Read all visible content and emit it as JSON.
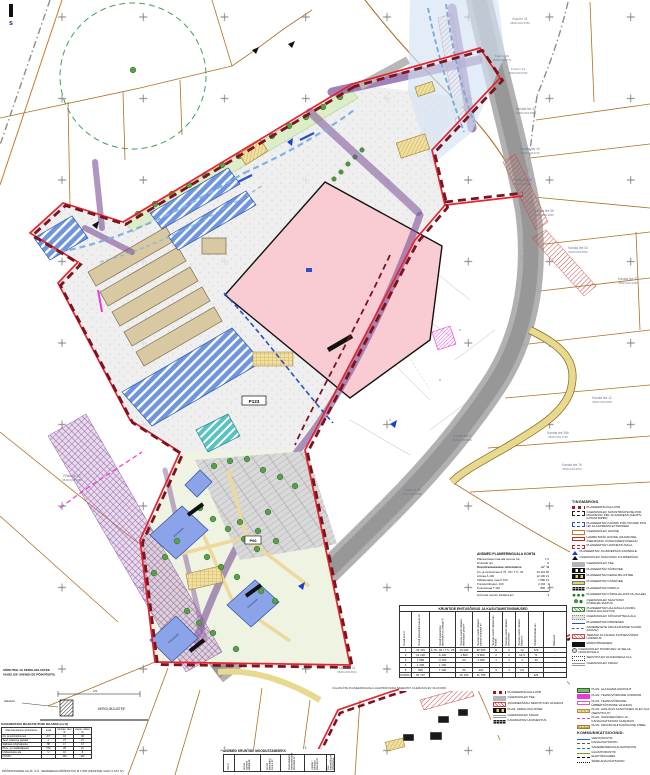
{
  "colors": {
    "plan_boundary_red": "#e4252f",
    "plan_boundary_maroon": "#7a1420",
    "parcel_orange": "#b06f25",
    "building_pink": "#f8ccd2",
    "water_blue": "#6f95dd",
    "utility_purple": "#7a4e96",
    "road_gray": "#a8a8a8",
    "magenta": "#e83ad8",
    "green_tree": "#5a9e4a",
    "path_yellow": "#edd99b"
  },
  "corner_mark": "s",
  "labels": {
    "p123": "P123",
    "p66": "P66",
    "floors": "3+5 korrust"
  },
  "captions": {
    "section1": "SÕIDUTEE JA KERGLIIKLUSTEE",
    "section2": "VAHELISE ÜHENDUSE PÕIKPROFIIL",
    "kergliiklustee": "KERGLIIKLUSTEE",
    "aarekivi": "Äärekivi",
    "dim": "4,5",
    "fragment": "VÄLJAVÕTE PLANEERINGUALA LÄHIPIIRKONNA SKEEMIST. OLEMASOLEV OLUKORD",
    "footer": "MÕÕDISTAMISE ALUS: O.Ü. GEODEESIA MÕÕDISTUS M 1:500 (KESKTEE VALD 3 KAT IV)"
  },
  "parcels": [
    {
      "name": "Kuuli tn 41",
      "code": "35201:001:0790"
    },
    {
      "name": "Kuuli tn 46",
      "code": "35201:001:0771"
    },
    {
      "name": "Kuuli tn 44",
      "code": "35201:001:0780"
    },
    {
      "name": "Kanala tee 42",
      "code": "35201:004:0695"
    },
    {
      "name": "Kanala tee 40",
      "code": "35201:004:0710"
    },
    {
      "name": "Kanala tee 38",
      "code": "35201:004:1550"
    },
    {
      "name": "Kanala tee 36",
      "code": "35201:004:0025"
    },
    {
      "name": "Kanala tee 34",
      "code": "35201:004:0640"
    },
    {
      "name": "Kanala tee 32",
      "code": "35201:004:1350"
    },
    {
      "name": "Kanala tee 12",
      "code": "35201:004:0065"
    },
    {
      "name": "Kanala tee 26b",
      "code": "35201:004:1760"
    },
    {
      "name": "Kanala tee 7b",
      "code": "35201:004:0013"
    },
    {
      "name": "Kanala tee 3",
      "code": "35201:004:0054"
    },
    {
      "name": "Laane tn 24",
      "code": "35201:004:0950"
    },
    {
      "name": "Laane tn 11",
      "code": "35201:004:0001"
    },
    {
      "name": "Piilaku tn 22",
      "code": "35201:004:1280"
    }
  ],
  "summary": {
    "title": "ANDMED PLANEERINGUALA KOHTA",
    "rows": [
      {
        "l": "Planeeritava maa-ala suurus ha",
        "v": "7,2"
      },
      {
        "l": "Kruntide arv",
        "v": "5"
      }
    ],
    "sub": "Krundi kasutamise sihtotstarve",
    "col1": "m²",
    "col2": "%",
    "uses": [
      [
        "Äri- ja tootmismaa Ä 75...95 / T 5...25",
        "34 115",
        "60"
      ],
      [
        "Ärimaa Ä 100",
        "12 130",
        "21"
      ],
      [
        "Üldkasutatav maa Ü 100",
        "7 580",
        "13"
      ],
      [
        "Transpordimaa L 100",
        "2 404",
        "4"
      ],
      [
        "Tootmismaa T 100",
        "895",
        "2"
      ]
    ],
    "note_l": "Korruste suurim lubatud arv",
    "note_v": "3"
  },
  "tables": {
    "main": {
      "title": "KRUNTIDE EHITUSÕIGUS JA KASUTAMISTINGIMUSED",
      "headers": [
        "Krundi pos nr",
        "Krundi planeeritud suurus m²",
        "Krundi kasutamise sihtotstarve ja osakaal %",
        "Hoonete suurim lubatud ehitisealune pind m²",
        "Hoonete suurim lubatud suletud brutopind m²",
        "Hoonete suurim lubatud arv krundil",
        "Hoonete suurim lubatud korruselisus",
        "Hoonete suurim lubatud kõrgus m",
        "Parkimiskohtade arv",
        "Märkused"
      ],
      "rows": [
        [
          "1",
          "34 115",
          "Ä 75...95 / T 5...25",
          "13 000",
          "30 600",
          "6",
          "2",
          "12",
          "123",
          "-"
        ],
        [
          "2",
          "12 130",
          "Ä 100",
          "1 800",
          "9 900",
          "2",
          "2",
          "14,5",
          "71",
          "-"
        ],
        [
          "3",
          "7 580",
          "Ü 100",
          "60",
          "1 055",
          "1",
          "1",
          "4",
          "32",
          "-"
        ],
        [
          "4",
          "1 406",
          "L 100",
          "-",
          "-",
          "-",
          "-",
          "-",
          "-",
          "-"
        ],
        [
          "5",
          "665",
          "T 100",
          "50",
          "200",
          "1",
          "1",
          "3,5",
          "-",
          "-"
        ],
        [
          "KOKKU",
          "56 737",
          "",
          "15 100",
          "41 755",
          "",
          "",
          "",
          "226",
          ""
        ]
      ]
    },
    "bilanss": {
      "title": "KAVANDATAVA MAAKASUTUSE BILANSS (ca %)",
      "headers": [
        "Maa kasutamise sihtotstarve",
        "kood",
        "olemas- olev %",
        "kavan- datav %"
      ],
      "rows": [
        [
          "Äri- ja tootmishooned",
          "Ä/T",
          "18",
          "38"
        ],
        [
          "Teed, platsid ja parklad",
          "L",
          "27",
          "27"
        ],
        [
          "Säilitatav kõrghaljastus",
          "HP",
          "17",
          "17"
        ],
        [
          "Muru- ja madalhaljastus",
          "HM",
          "28",
          "10"
        ],
        [
          "Üldkasutatav ala",
          "Ü",
          "10",
          "8"
        ],
        [
          "KOKKU",
          "",
          "100",
          "100"
        ]
      ]
    },
    "moodust": {
      "title": "ANDMED KRUNTIDE MOODUSTAMISEKS",
      "headers": [
        "Pos nr",
        "Krundi aadressi ettepanek",
        "Krundi planeeritud suurus m²",
        "Moodustatakse olemasolevatest üksustest m²",
        "Liidetav / lahutatav maa-ala m²",
        "Uue katastriüksuse sihtotstarve"
      ]
    }
  },
  "legend": {
    "title": "TINGMÄRGID",
    "items": [
      {
        "s": "sw-redbr",
        "label": "PLANEERINGUALA PIIR"
      },
      {
        "s": "sw-bdash",
        "label": "OLEMASOLEV KATASTRIÜKSUSE PIIR, MUUDETAV PIIR JA AADRESS (KEHTIV KATASTRIPIIR)"
      },
      {
        "s": "sw-bludash",
        "label": "PLANEERITAV KRUNDI PIIR, KRUNDI POS NR JA AADRESSI ETTEPANEK"
      },
      {
        "s": "sw-orect",
        "label": "OLEMASOLEV HOONE"
      },
      {
        "s": "sw-rrect",
        "label": "LAMMUTATAV HOONE (VAJADUSEL ASENDATAV UUSHOONESTUSEGA)"
      },
      {
        "s": "sw-rdash",
        "label": "PLANEERITAV HOONESTUSALA"
      },
      {
        "s": "sw-btri",
        "label": "PLANEERITAV JUURDEPÄÄS KRUNDILE"
      },
      {
        "s": "sw-ktri",
        "label": "OLEMASOLEV SÄILITATAV JUURDEPÄÄS"
      },
      {
        "s": "sw-gbar",
        "label": "OLEMASOLEV TEE"
      },
      {
        "s": "sw-zebra",
        "label": "PLANEERITAV SÕIDUTEE"
      },
      {
        "s": "sw-yzebra",
        "label": "PLANEERITAV KERGLIIKLUSTEE"
      },
      {
        "s": "sw-ybar",
        "label": "PLANEERITAV KÕNNITEE"
      },
      {
        "s": "sw-pgrid",
        "label": "PLANEERITAV PARKLA"
      },
      {
        "s": "sw-trees",
        "label": "PLANEERITAV KÕRGHALJASTUS (ALLEE)"
      },
      {
        "s": "sw-tclu",
        "label": "OLEMASOLEV SÄILITATAV KÕRGHALJASTUS"
      },
      {
        "s": "sw-ghatch",
        "label": "PLANEERITAV HALJASALA (MURU, MADALHALJASTUS)"
      },
      {
        "s": "sw-gdots",
        "label": "OLEMASOLEV KÕVAKATTEGA ALA"
      },
      {
        "s": "sw-bline",
        "label": "PLANEERITAV PIIRDEAED"
      },
      {
        "s": "sw-bwave",
        "label": "SADEMEVETE ÄRAJUHTIMISE SUUND (KRAAV)"
      },
      {
        "s": "sw-rhatch",
        "label": "TEEMAA JA TÄNAVA KAITSEVÖÖNDI LAIENDUS"
      },
      {
        "s": "sw-kbar",
        "label": "MÜRATÕKKESEIN"
      },
      {
        "s": "sw-gear",
        "label": "OLEMASOLEV PUURKAEV JA SELLE HOOLDUSALA"
      },
      {
        "s": "sw-dotr",
        "label": "SERVITUUDI VAJADUSEGA ALA"
      },
      {
        "s": "sw-gpair",
        "label": "OLEMASOLEV KRAAV"
      }
    ],
    "items2": [
      {
        "s": "sw-grect",
        "label": "PLAN. ALAJAAMA ASUKOHT"
      },
      {
        "s": "sw-mrect",
        "label": "PLAN. TEHNOVÕRKUDE KORIDOR"
      },
      {
        "s": "sw-pout",
        "label": "PLAN. TEHNOVÕRKUDE ÜMBERTÕSTMISE VAJADUS"
      },
      {
        "s": "sw-thatch",
        "label": "PLAN. AVALIKUS KASUTUSES OLEV ALA (SERVITUUT)"
      },
      {
        "s": "sw-mdash",
        "label": "PLAN. ÜHISVEEVÄRGI JA -KANALISATSIOONI ÜHENDUS"
      },
      {
        "s": "sw-tgrid",
        "label": "PLAN. KRUNDI EHITUSÕIGUSE TABEL"
      }
    ],
    "comm_title": "KOMMUNIKATSIOONID:",
    "comm": [
      {
        "s": "sw-lv",
        "label": "VEETORUSTIK"
      },
      {
        "s": "sw-lk",
        "label": "KANALISATSIOON"
      },
      {
        "s": "sw-lsv",
        "label": "SADEMEVEEKANALISATSIOON"
      },
      {
        "s": "sw-lg",
        "label": "GAASITORUSTIK"
      },
      {
        "s": "sw-lel",
        "label": "ELEKTRIKAABEL"
      },
      {
        "s": "sw-ls",
        "label": "SIDEKANALISATSIOON"
      }
    ]
  },
  "mini": {
    "title": "TINGMÄRGID",
    "items": [
      {
        "s": "sw-redbr",
        "label": "PLANEERINGUALA PIIR"
      },
      {
        "s": "sw-gbar",
        "label": "OLEMASOLEV TEE"
      },
      {
        "s": "sw-rhatch",
        "label": "JUURDEPÄÄSU SERVITUUDI VAJADUS"
      },
      {
        "s": "sw-yzebra",
        "label": "PLAN. KERGLIIKLUSTEE"
      },
      {
        "s": "sw-gpair",
        "label": "OLEMASOLEV KRAAV"
      },
      {
        "s": "sw-pgrid",
        "label": "KAVANDATAV HOONESTUS"
      }
    ]
  }
}
